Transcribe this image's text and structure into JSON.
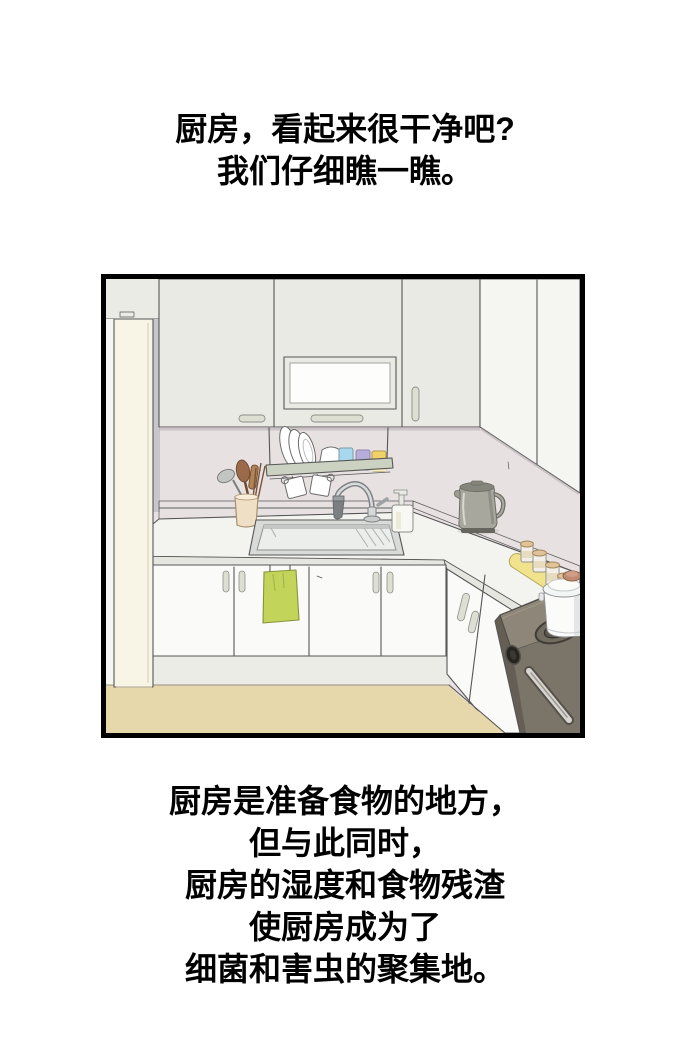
{
  "page": {
    "background": "#ffffff"
  },
  "captions": {
    "top": {
      "lines": [
        "厨房，看起来很干净吧?",
        "我们仔细瞧一瞧。"
      ]
    },
    "bottom": {
      "lines": [
        "厨房是准备食物的地方，",
        "但与此同时，",
        "厨房的湿度和食物残渣",
        "使厨房成为了",
        "细菌和害虫的聚集地。"
      ]
    }
  },
  "panel": {
    "description": "手绘插画：整洁的厨房。吊柜和翻板柜门、沥水碗碟架上放着盘子和蓝紫黄三色杯子、挂着两个马克杯、餐具筒插着木勺和筷子、不锈钢水槽和水龙头、洗洁精瓶、电热水壶、黄色托盘上的调味罐、燃气灶上放着白色汤锅、下柜门挂着绿色抹布、左侧是白色冰箱、米色地板",
    "border_color": "#000000",
    "colors": {
      "pagebg": "#ffffff",
      "text": "#000000",
      "border": "#000000",
      "line": "#565656",
      "wall": "#e8e1e2",
      "cab": "#e9eae3",
      "cabr": "#f5f5f2",
      "panelwhite": "#fdfdfc",
      "handle": "#dcdfd2",
      "fridge": "#f8f5e7",
      "gap": "#c7c7cb",
      "counter": "#f3f3ef",
      "edge": "#e6e6e0",
      "doors": "#fafaf8",
      "kick": "#ecece7",
      "floor": "#e7d8ab",
      "rack": "#ccd2c1",
      "towel": "#c3d45a",
      "tray": "#f1e28c",
      "kettle": "#a7a79d",
      "kettledark": "#85857c",
      "stovetop": "#8d8679",
      "stoveface": "#7b7468",
      "stovedark": "#645e55",
      "pot": "#fbfbfa",
      "potknob": "#c08a72",
      "cupblue": "#a8d8ee",
      "cuppurple": "#b6addb",
      "cupyellow": "#f0d269",
      "wood": "#9b6a4b",
      "wooddark": "#7a5336",
      "ucup": "#eedfc5",
      "steel": "#c9cdce",
      "sinkrim": "#d9dbd8",
      "sinkin": "#eceeec"
    }
  }
}
